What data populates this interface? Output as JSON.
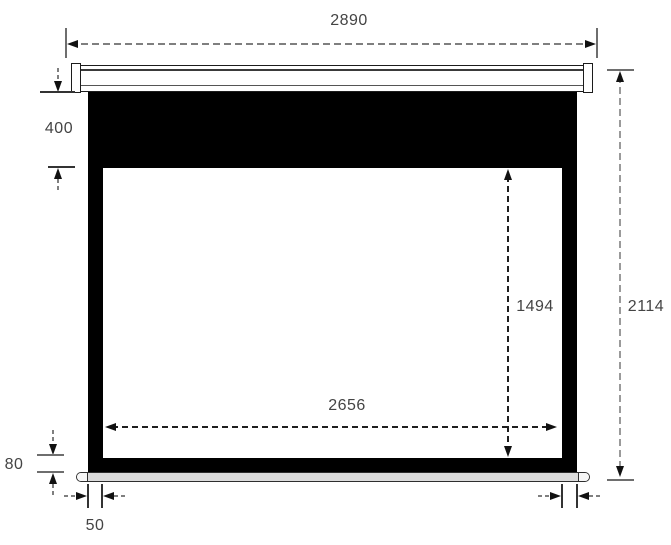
{
  "diagram_type": "projection-screen-front-view-dimensions",
  "labels": {
    "overall_width": "2890",
    "drop_height": "400",
    "viewing_height": "1494",
    "total_height": "2114",
    "viewing_width": "2656",
    "bottom_border_height": "80",
    "side_border_width": "50"
  },
  "colors": {
    "background": "#ffffff",
    "screen_cloth": "#000000",
    "viewing_area": "#ffffff",
    "casing_fill": "#ffffff",
    "casing_outline": "#1c1c1c",
    "weight_bar_fill": "#dcdcdc",
    "dim_line_gray": "#7f7f7f",
    "dim_line_dark": "#1f1f1f",
    "arrow_color": "#111111",
    "label_text": "#444444"
  }
}
